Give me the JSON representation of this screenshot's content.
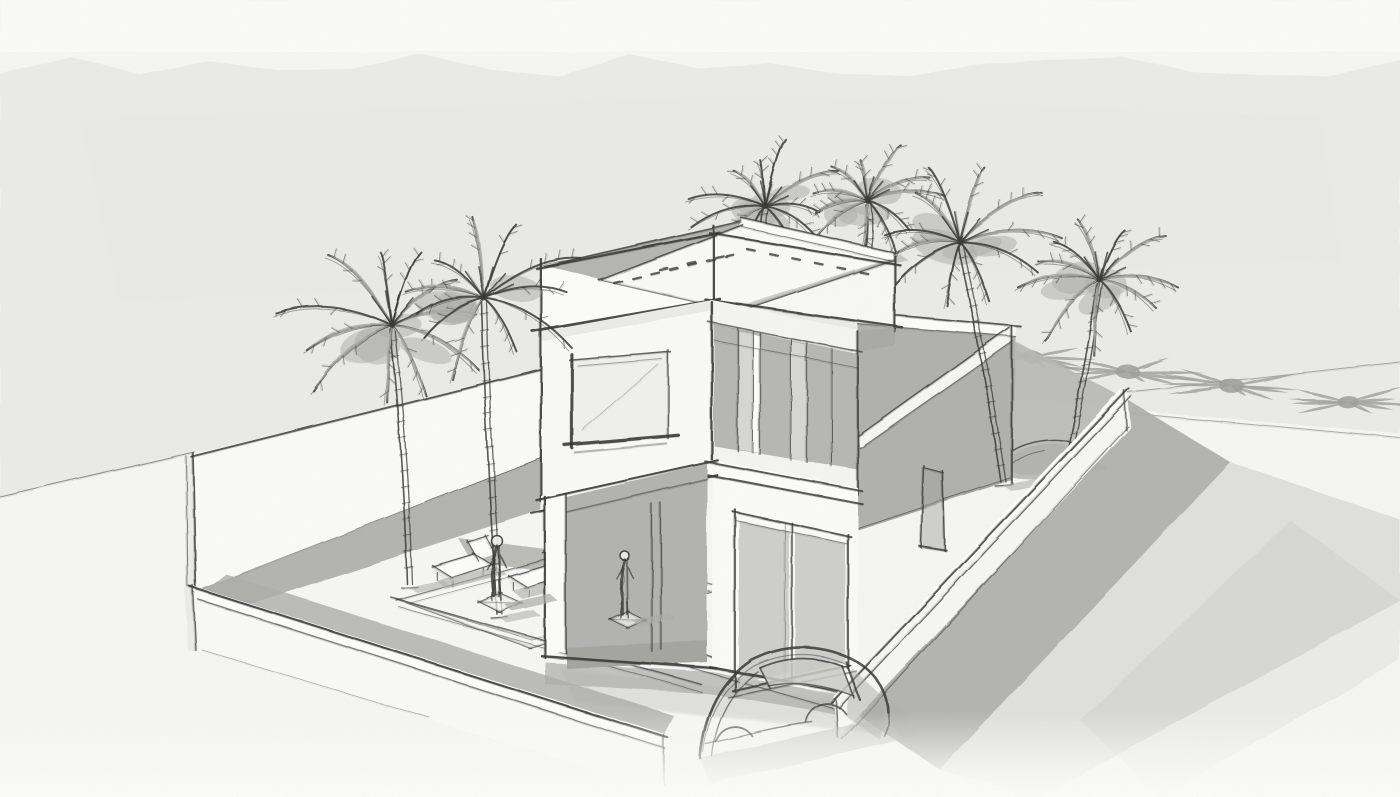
{
  "scene": {
    "title": "Villa concept sketch",
    "description": "Hand-drawn architectural concept sketch of a modern two-storey flat-roof villa with roof parapet terrace, walled plot, pool terrace with two sun loungers, two standing human figures, six palm trees casting star-shaped shadows, and a faintly sketched car at the driveway gate",
    "style": "pencil and grey-marker perspective sketch on textured paper",
    "objects": {
      "palm_trees": 6,
      "palm_shadow_stars": 4,
      "human_figures": 2,
      "sun_loungers": 2,
      "cars": 1,
      "storeys": 2,
      "perimeter_walls": 3,
      "pool_terraces": 1
    }
  },
  "palette": {
    "paper": "#f5f5f3",
    "paper_top": "#fbfbfa",
    "wash": "#e9e9e7",
    "white_wall": "#fafaf8",
    "bright_wall": "#fcfcfa",
    "deck": "#f9f9f7",
    "shadow": "#acacaa",
    "shadow_deep": "#9e9e9c",
    "glass": "#c9c9c6",
    "pane_light": "#d6d6d3",
    "recess": "#b2b2b0",
    "ink": "#383838",
    "ink_light": "#8d8d8b"
  }
}
